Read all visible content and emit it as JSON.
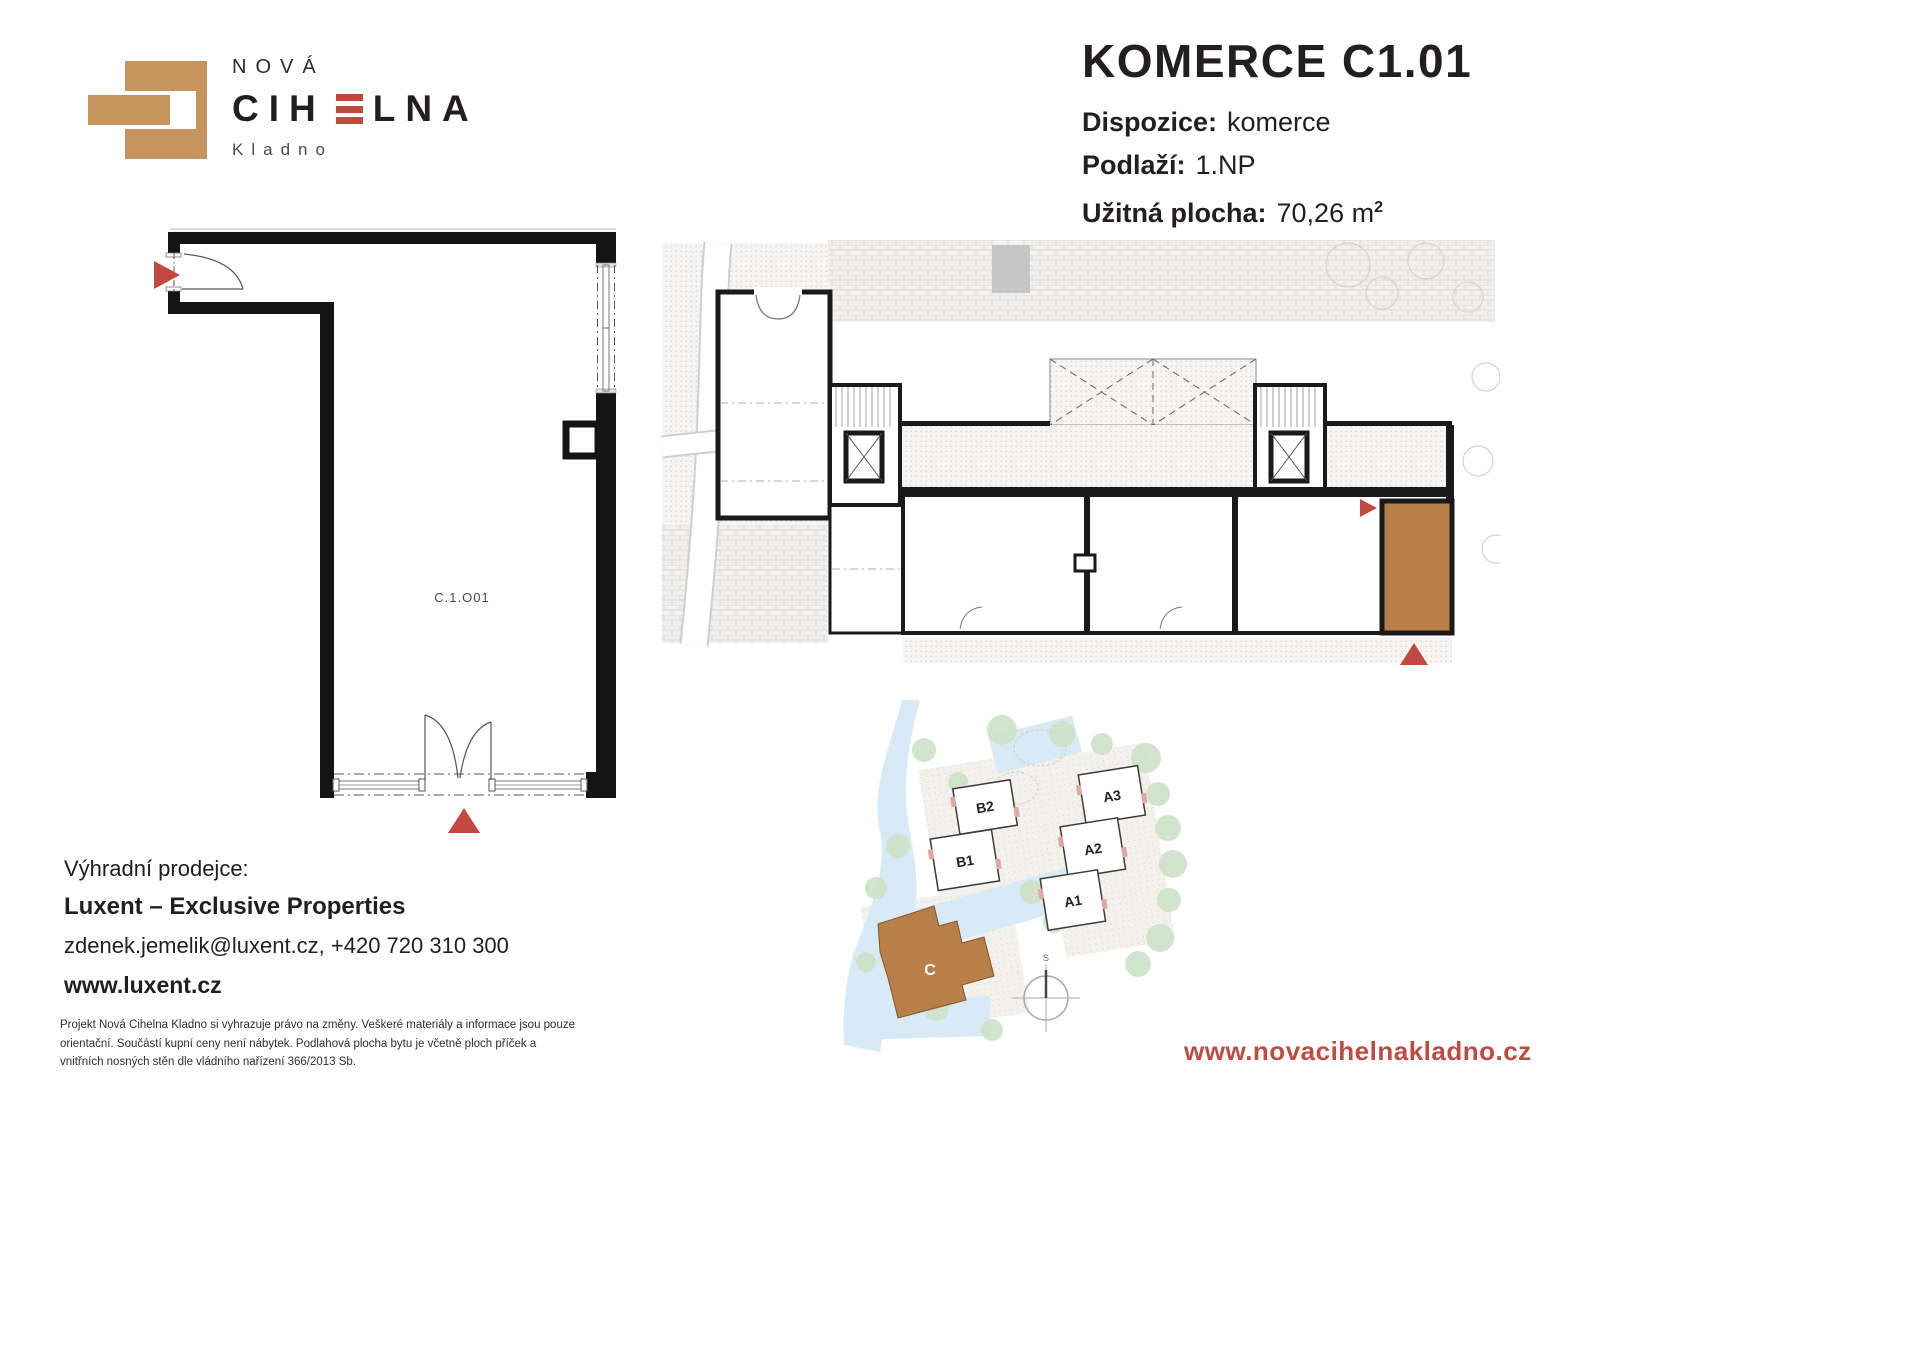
{
  "logo": {
    "line_top": "NOVÁ",
    "name_pre": "CIH",
    "name_post": "LNA",
    "city": "Kladno"
  },
  "title": {
    "heading": "KOMERCE C1.01",
    "rows": [
      {
        "label": "Dispozice:",
        "value": "komerce",
        "sup": ""
      },
      {
        "label": "Podlaží:",
        "value": "1.NP",
        "sup": ""
      },
      {
        "label": "Užitná plocha:",
        "value": "70,26 m",
        "sup": "2"
      }
    ]
  },
  "unit_plan": {
    "label": "C.1.O01"
  },
  "site_plan": {
    "buildings": [
      "B2",
      "B1",
      "A3",
      "A2",
      "A1"
    ],
    "highlighted_building": "C",
    "compass_label": "S"
  },
  "contact": {
    "heading": "Výhradní prodejce:",
    "company": "Luxent – Exclusive Properties",
    "email_phone": "zdenek.jemelik@luxent.cz, +420 720 310 300",
    "website": "www.luxent.cz"
  },
  "disclaimer": "Projekt Nová Cihelna Kladno si vyhrazuje právo na změny. Veškeré materiály a informace jsou pouze orientační. Součástí kupní ceny není nábytek. Podlahová plocha bytu je včetně ploch příček a vnitřních nosných stěn dle vládního nařízení 366/2013 Sb.",
  "footer": {
    "website": "www.novacihelnakladno.cz"
  },
  "colors": {
    "accent_red": "#C1493F",
    "brick_tan": "#C6945C",
    "highlight_brown": "#B97F48",
    "tree_green": "#CDE2C8",
    "road_blue": "#D9EAF7"
  }
}
